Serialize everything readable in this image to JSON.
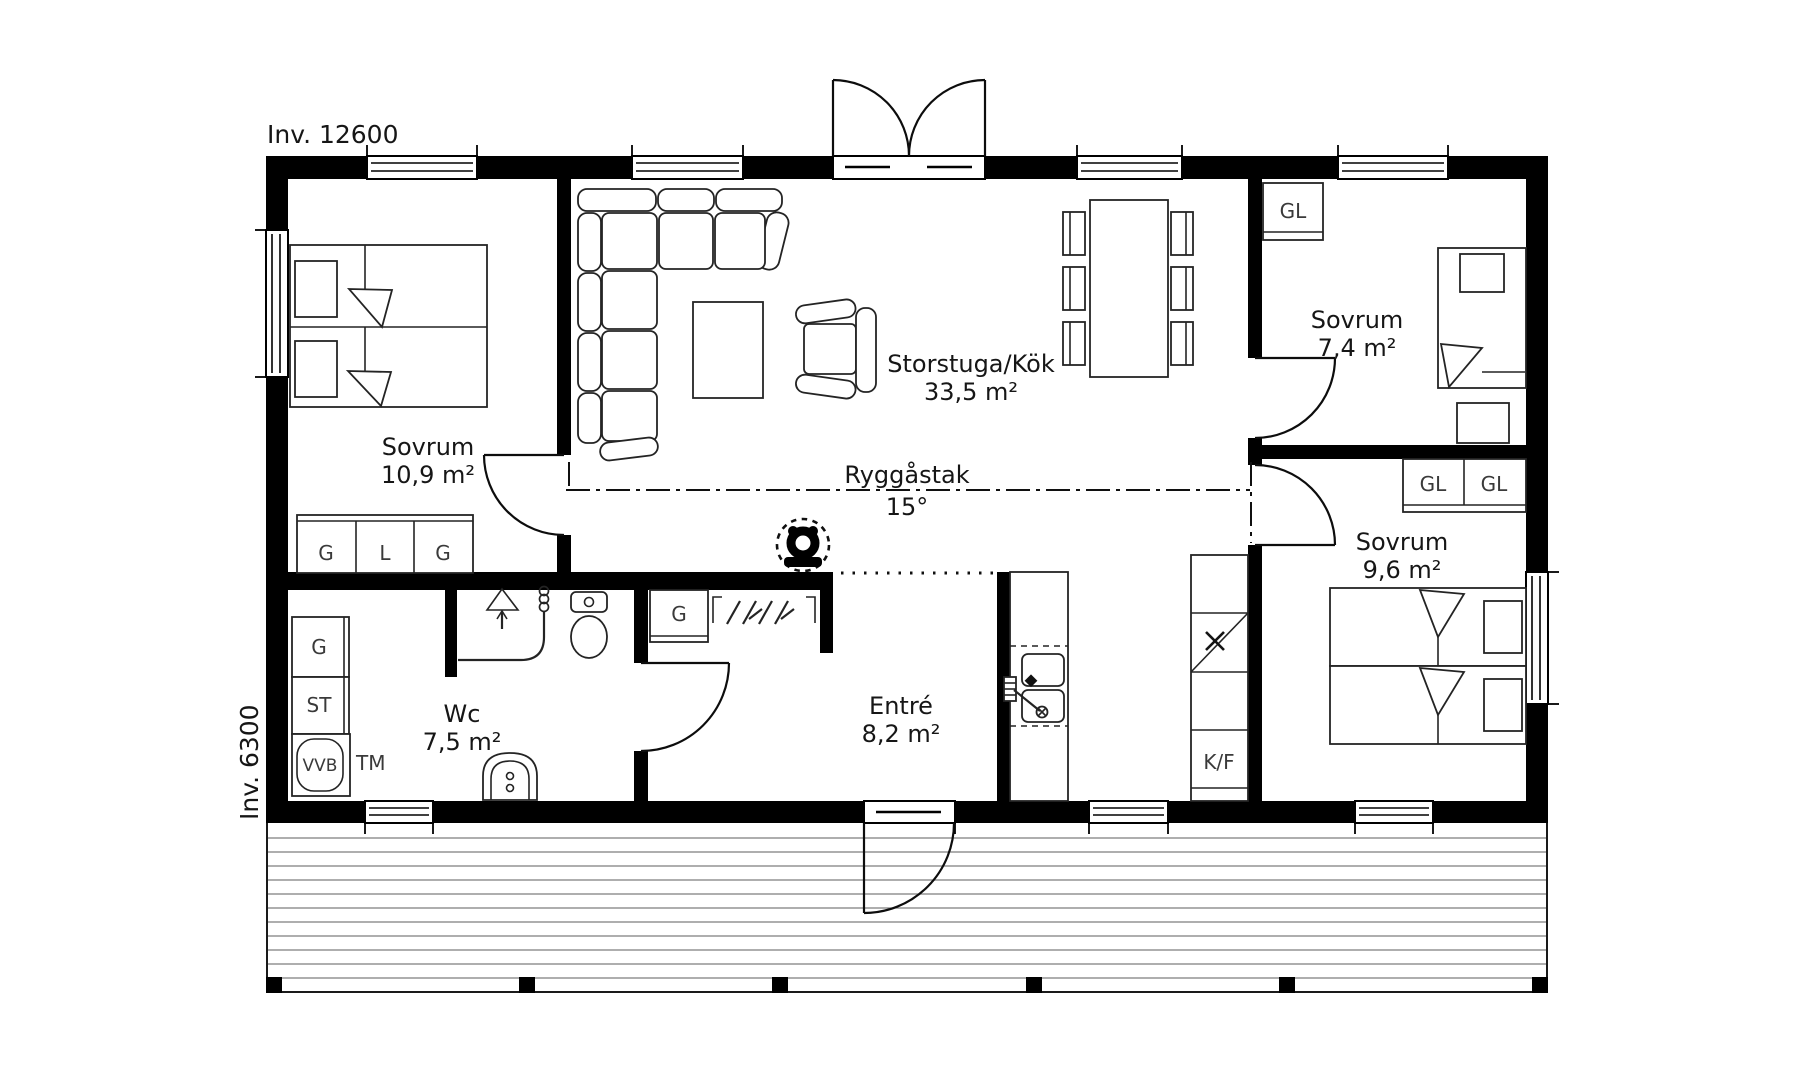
{
  "title": {
    "width_label": "Inv. 12600",
    "depth_label": "Inv. 6300"
  },
  "ridge": {
    "label": "Ryggåstak",
    "slope": "15°"
  },
  "rooms": {
    "bedroom_large": {
      "name": "Sovrum",
      "area": "10,9 m²"
    },
    "living_kitchen": {
      "name": "Storstuga/Kök",
      "area": "33,5 m²"
    },
    "bedroom_small": {
      "name": "Sovrum",
      "area": "7,4 m²"
    },
    "bedroom_medium": {
      "name": "Sovrum",
      "area": "9,6 m²"
    },
    "wc": {
      "name": "Wc",
      "area": "7,5 m²"
    },
    "entry": {
      "name": "Entré",
      "area": "8,2 m²"
    }
  },
  "closets": {
    "bedroom_large_g1": "G",
    "bedroom_large_l": "L",
    "bedroom_large_g2": "G",
    "bedroom_small_gl": "GL",
    "bedroom_medium_gl1": "GL",
    "bedroom_medium_gl2": "GL",
    "hall_g": "G",
    "wc_g": "G",
    "wc_st": "ST",
    "wc_vvb": "VVB",
    "wc_tm": "TM",
    "kitchen_kf": "K/F"
  },
  "colors": {
    "ink": "#000000",
    "label_text": "#161616",
    "fixture_text": "#3a3a3a",
    "deck_line": "#7d7d7d",
    "background": "#ffffff"
  }
}
